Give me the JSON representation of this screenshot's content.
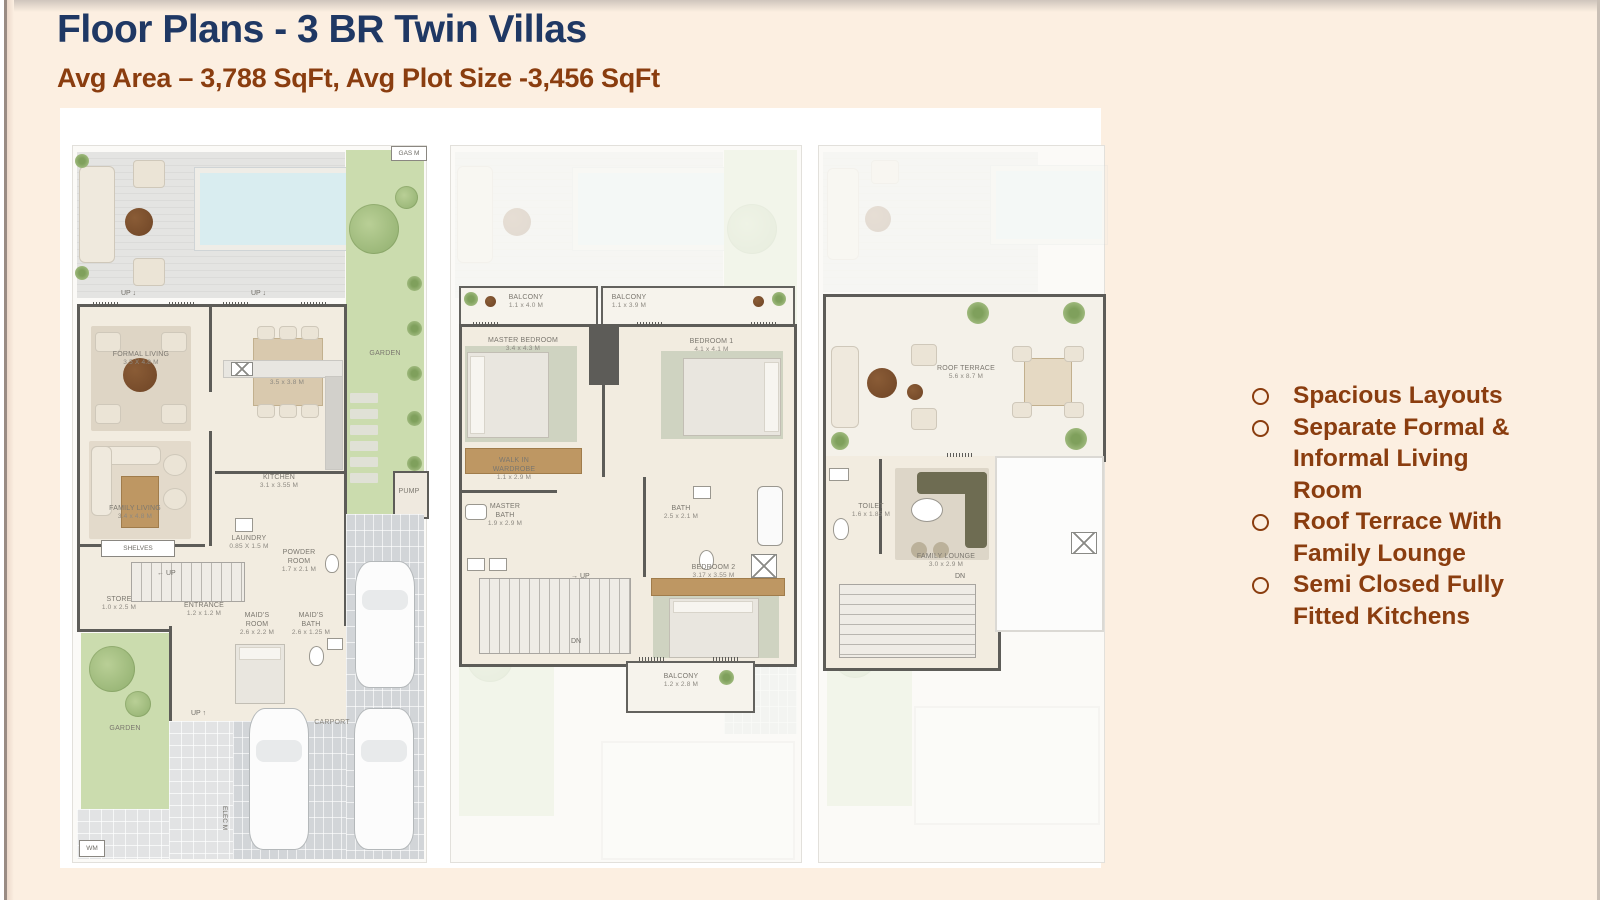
{
  "header": {
    "title": "Floor Plans - 3 BR Twin Villas",
    "subtitle": "Avg Area – 3,788 SqFt, Avg Plot Size -3,456 SqFt"
  },
  "features": [
    "Spacious Layouts",
    "Separate Formal & Informal Living Room",
    "Roof Terrace With Family Lounge",
    "Semi Closed Fully Fitted Kitchens"
  ],
  "colors": {
    "background": "#FCEFE1",
    "title": "#1F3864",
    "accent_brown": "#8A3D0F",
    "wall": "#5D5C58",
    "garden_green": "#CBDCAE",
    "pool_blue": "#D9EDF0"
  },
  "plans": {
    "ground": {
      "gas_meter": "GAS M",
      "up_terrace_left": "UP ↓",
      "up_terrace_right": "UP ↓",
      "garden_side": "GARDEN",
      "formal_living": {
        "n": "FORMAL LIVING",
        "d": "3.5 X 4.8 M"
      },
      "dining_room": {
        "n": "DINING ROOM",
        "d": "3.5 x 3.8 M"
      },
      "family_living": {
        "n": "FAMILY LIVING",
        "d": "3.4 x 4.8 M"
      },
      "kitchen": {
        "n": "KITCHEN",
        "d": "3.1 x 3.55 M"
      },
      "laundry": {
        "n": "LAUNDRY",
        "d": "0.85 X 1.5 M"
      },
      "powder_room": {
        "n": "POWDER ROOM",
        "d": "1.7 x 2.1 M"
      },
      "shelves": "SHELVES",
      "stairs_up": "UP",
      "store": {
        "n": "STORE",
        "d": "1.0 x 2.5 M"
      },
      "entrance": {
        "n": "ENTRANCE",
        "d": "1.2 x 1.2 M"
      },
      "maids_room": {
        "n": "MAID'S ROOM",
        "d": "2.6 x 2.2 M"
      },
      "maids_bath": {
        "n": "MAID'S BATH",
        "d": "2.6 x 1.25 M"
      },
      "pump": "PUMP",
      "garden_rear": "GARDEN",
      "carport": "CARPORT",
      "up_path": "UP ↑",
      "elec_meter": "ELEC M",
      "washing_machine": "WM"
    },
    "first": {
      "balcony_left": {
        "n": "BALCONY",
        "d": "1.1 x 4.0 M"
      },
      "balcony_right": {
        "n": "BALCONY",
        "d": "1.1 x 3.9 M"
      },
      "master_bedroom": {
        "n": "MASTER BEDROOM",
        "d": "3.4 x 4.3 M"
      },
      "bedroom_1": {
        "n": "BEDROOM 1",
        "d": "4.1 x 4.1 M"
      },
      "walk_in_wardrobe": {
        "n": "WALK IN WARDROBE",
        "d": "1.1 x 2.9 M"
      },
      "master_bath": {
        "n": "MASTER BATH",
        "d": "1.9 x 2.9 M"
      },
      "bath": {
        "n": "BATH",
        "d": "2.5 x 2.1 M"
      },
      "stairs_up": "UP",
      "stairs_dn": "DN",
      "bedroom_2": {
        "n": "BEDROOM 2",
        "d": "3.17 x 3.55 M"
      },
      "balcony_rear": {
        "n": "BALCONY",
        "d": "1.2 x 2.8 M"
      }
    },
    "roof": {
      "roof_terrace": {
        "n": "ROOF TERRACE",
        "d": "5.6 x 8.7 M"
      },
      "toilet": {
        "n": "TOILET",
        "d": "1.6 x 1.85 M"
      },
      "family_lounge": {
        "n": "FAMILY LOUNGE",
        "d": "3.0 x 2.9 M"
      },
      "stairs_dn": "DN"
    }
  }
}
